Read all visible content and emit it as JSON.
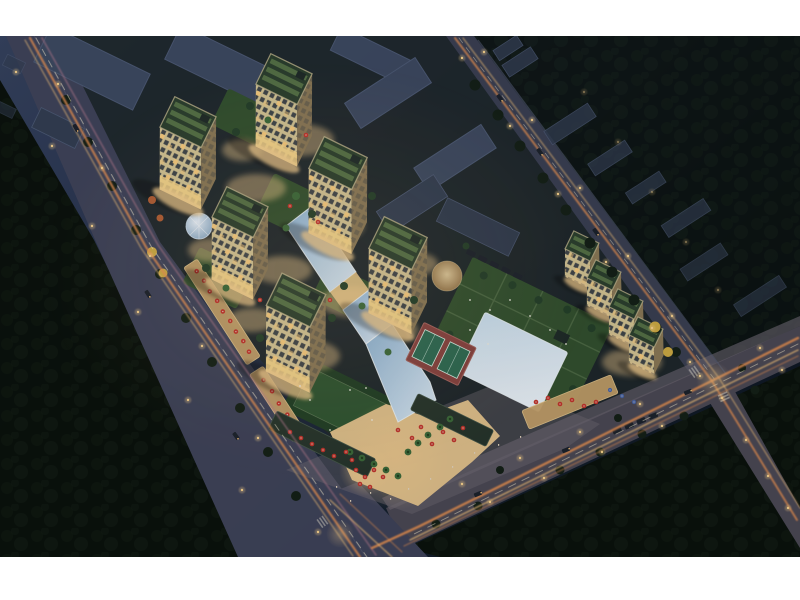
{
  "meta": {
    "title": "Aerial night rendering of an illuminated mixed-use residential development",
    "alt": "Bird's-eye night view of a lit apartment complex with mid-rise towers, a diagonal glass atrium ribbon, a large square skylight, roof gardens, tennis courts, a retail plaza with red umbrellas and palm trees, surrounded by dark city blocks and avenues streaked with warm light trails",
    "width_px": 800,
    "height_px": 600
  },
  "frame": {
    "background": "#ffffff",
    "top_margin_px": 36,
    "bottom_margin_px": 43,
    "render_width_px": 800,
    "render_height_px": 521
  },
  "palette": {
    "bg-top": "#35425e",
    "bg-mid": "#25304a",
    "bg-right": "#14202e",
    "bg-deep": "#0e1724",
    "canopy-dark": "#0a110c",
    "canopy-mid": "#111c12",
    "canopy-spot": "#16241a",
    "site-base": "#1f282b",
    "road-main": "#40445a",
    "road-top": "#3b4053",
    "road-bottom": "#4c4955",
    "sidewalk": "#6b6570",
    "apron": "#716b74",
    "block-gray": "#3e4a61",
    "block-top": "#4d5a74",
    "block-dark": "#333e52",
    "roof-green": "#2c402e",
    "roof-strip": "#5e7b4a",
    "parapet": "#c3b88e",
    "lawn": "#2f5631",
    "lawn-dark": "#213f25",
    "garden": "#33512f",
    "path-green": "#54714a",
    "facade": "#d8c795",
    "facade-side": "#8d7a57",
    "window-dark": "#2c3440",
    "window-lit": "#ffcf7e",
    "base-lit": "#ffd98a",
    "glass-a": "#8fb6d6",
    "glass-b": "#e2eef8",
    "glass-sky-a": "#cfe3f2",
    "glass-sky-b": "#f4f9fd",
    "glass-grid": "#f4fafd",
    "glow-warm": "#f7cf8f",
    "trail-orange": "#ef9452",
    "trail-amber": "#ffc97d",
    "trail-white": "#fff3d2",
    "trail-pink": "#bd7f92",
    "light-dot": "#ffd78f",
    "tree-dark": "#142017",
    "tree-mid": "#24402a",
    "tree-bright": "#3c6b3a",
    "tree-yellow": "#d2ae44",
    "tree-orange": "#b55f35",
    "umbrella-red": "#c6342c",
    "umbrella-blue": "#4a66a8",
    "plaza": "#e6c48d",
    "court-base": "#8a4340",
    "court-green": "#2d6b52",
    "white-dot": "#f3efe2",
    "car-dark": "#1c222c"
  },
  "scene": {
    "time_of_day": "night",
    "view": "aerial three-quarter bird's-eye",
    "lit_towers_count": 6,
    "terraced_slab_steps": 4,
    "features": [
      "residential-towers-with-green-roofs",
      "glass-atrium-ribbon",
      "central-square-skylight",
      "glass-dome-pavilion",
      "roof-garden",
      "sports-field",
      "tennis-courts",
      "retail-plaza-with-red-umbrellas",
      "palm-trees",
      "street-light-trails",
      "four-way-intersection",
      "unlit-neighborhood-blocks",
      "dark-tree-canopy"
    ],
    "roads": [
      "west-avenue-diagonal",
      "north-road-diagonal",
      "south-avenue",
      "southeast-branch-road",
      "south-branch-road"
    ]
  }
}
